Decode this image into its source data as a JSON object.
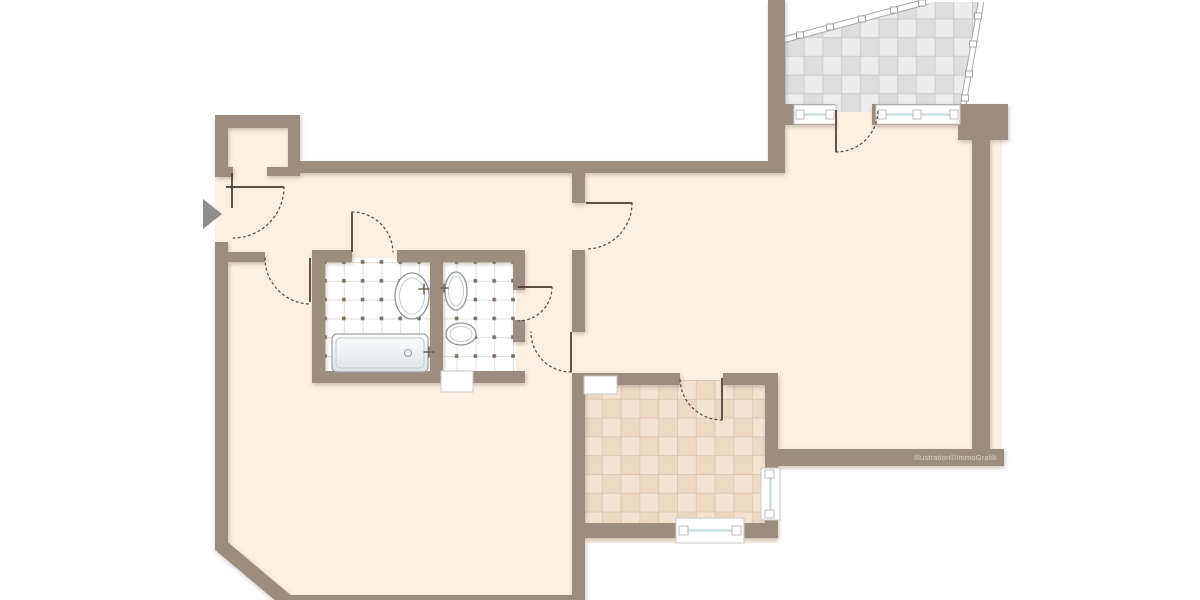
{
  "watermark": {
    "text": "Illustration©ImmoGrafik"
  },
  "entrance": {
    "icon": "entrance-arrow"
  },
  "colors": {
    "outside": "#ffffff",
    "floor": "#fbf0e3",
    "wall": "#9b8e81",
    "door-line": "#4a382c",
    "arc-line": "#5f4f41",
    "glass": "#cfe0e2",
    "frame-stroke": "#c9c9c9",
    "bath-bg": "#ffffff",
    "bath-line": "#e3e0dc",
    "bath-dot": "#7d7060",
    "kitchen-a": "#f3e4d2",
    "kitchen-b": "#edd9c2",
    "kitchen-line": "#dcc8b2",
    "balcony-a": "#ececec",
    "balcony-b": "#dedede",
    "balcony-line": "#cbcbcb",
    "railing": "#a8a8a8",
    "fixture": "#8f9499",
    "arrow": "#8e8e8e",
    "watermark": "#d8d0c4"
  }
}
